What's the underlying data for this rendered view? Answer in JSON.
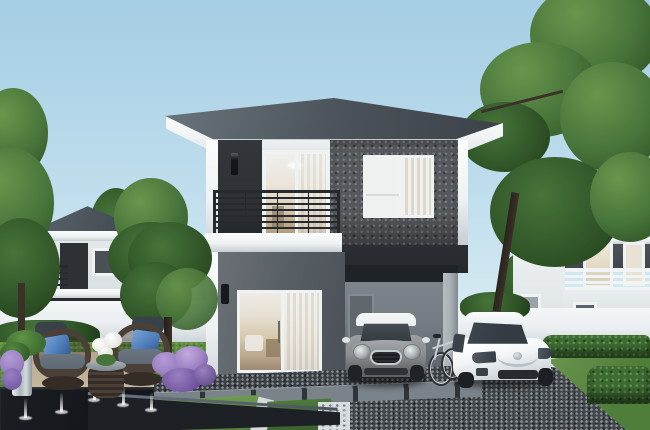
{
  "scene": {
    "title": "Modern two-story detached house — exterior 3D rendering",
    "time_of_day": "daylight",
    "elements": [
      "sky",
      "neighbor-house-left",
      "neighbor-house-right",
      "white-perimeter-fence",
      "main-house",
      "hip-roof",
      "white-fascia",
      "dark-accent-panel",
      "stone-feature-wall",
      "balcony",
      "balcony-railing",
      "balcony-sliding-door",
      "upper-window",
      "wall-lamps",
      "living-room-sliding-door",
      "carport",
      "carport-inner-door",
      "silver-mini-hatchback",
      "white-sedan",
      "bicycle",
      "dark-driveway",
      "gravel-strip",
      "paver-walkway",
      "lawn-strips",
      "rattan-chairs",
      "rattan-table",
      "white-flower-bouquet",
      "silver-planter-pot",
      "reflecting-pond",
      "fountain-jets",
      "purple-flower-bushes",
      "fern-plant",
      "large-right-tree",
      "left-trees",
      "trimmed-hedges",
      "grass-yard"
    ]
  },
  "colors": {
    "sky_top": "#a5cde3",
    "sky_mid": "#bfdeed",
    "sky_low": "#dcedf3",
    "roof_light": "#6a747c",
    "roof_dark": "#3c4248",
    "trim_white": "#eff2f3",
    "trim_shadow": "#c6cdd2",
    "wall_panel_dark": "#2d3034",
    "wall_stone": "#55585c",
    "wall_stone_dark": "#3e4145",
    "wall_lower": "#636a71",
    "wall_lower_dark": "#4a5056",
    "beam_dark": "#25282d",
    "railing": "#26292d",
    "glass_cool": "#e8edee",
    "interior_warm": "#c2ab8c",
    "carport_back": "#757c83",
    "carport_door": "#60676d",
    "carport_ceiling": "#1f2227",
    "carport_pillar": "#a9b0b5",
    "fence_white": "#eaeef0",
    "fence_shade": "#bfc8cd",
    "driveway": "#42474b",
    "driveway_dark": "#31353a",
    "gravel_dark": "#3c4146",
    "paver": "#7b838a",
    "paver_gap": "#2f3438",
    "gravel_white": "#d4dade",
    "grass_light": "#6d9a50",
    "grass_mid": "#4f7d3a",
    "grass_dark": "#3a6130",
    "tree_light": "#69964c",
    "tree_mid": "#47743a",
    "tree_dark": "#2c4f24",
    "trunk": "#3a3128",
    "hedge": "#3c6c2f",
    "hedge_dark": "#28481f",
    "patio": "#b5a68b",
    "pond": "#14181c",
    "pond_edge": "#6e7880",
    "flower_purple": "#9a7fc2",
    "flower_purple_dark": "#6b519b",
    "wicker": "#4a4037",
    "wicker_dark": "#352d25",
    "cushion_gray": "#5f6973",
    "cushion_blue": "#4c7bb9",
    "cushion_dark": "#39414a",
    "pot_silver": "#c3cacf",
    "mini_body": "#8d9092",
    "mini_roof": "#eceeef",
    "car_white": "#f2f4f6",
    "window_dark": "#343b42",
    "white_flower": "#f4f4f0"
  }
}
